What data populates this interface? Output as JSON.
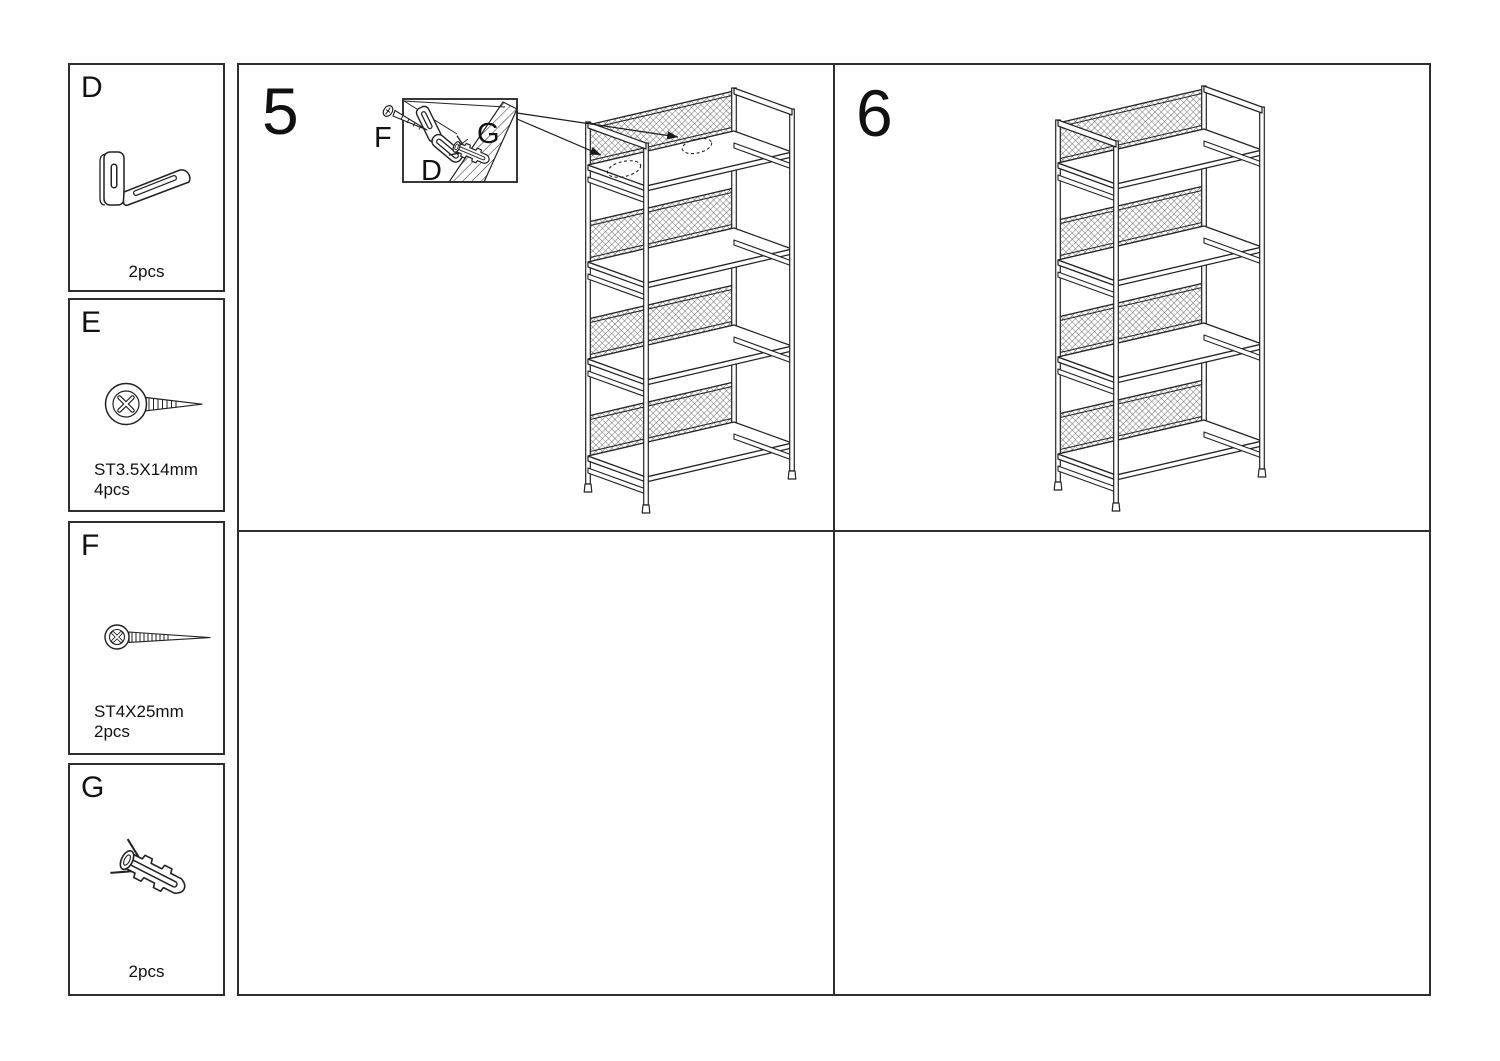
{
  "colors": {
    "line": "#222222",
    "border": "#2e2e2e",
    "background": "#ffffff"
  },
  "parts": [
    {
      "letter": "D",
      "qty": "2pcs",
      "spec": "",
      "icon": "l-bracket-icon"
    },
    {
      "letter": "E",
      "qty": "4pcs",
      "spec": "ST3.5X14mm",
      "icon": "short-screw-icon"
    },
    {
      "letter": "F",
      "qty": "2pcs",
      "spec": "ST4X25mm",
      "icon": "long-screw-icon"
    },
    {
      "letter": "G",
      "qty": "2pcs",
      "spec": "",
      "icon": "wall-anchor-icon"
    }
  ],
  "steps": [
    {
      "number": "5",
      "callout": {
        "labels": {
          "screw": "F",
          "bracket": "D",
          "anchor": "G"
        }
      }
    },
    {
      "number": "6"
    }
  ]
}
